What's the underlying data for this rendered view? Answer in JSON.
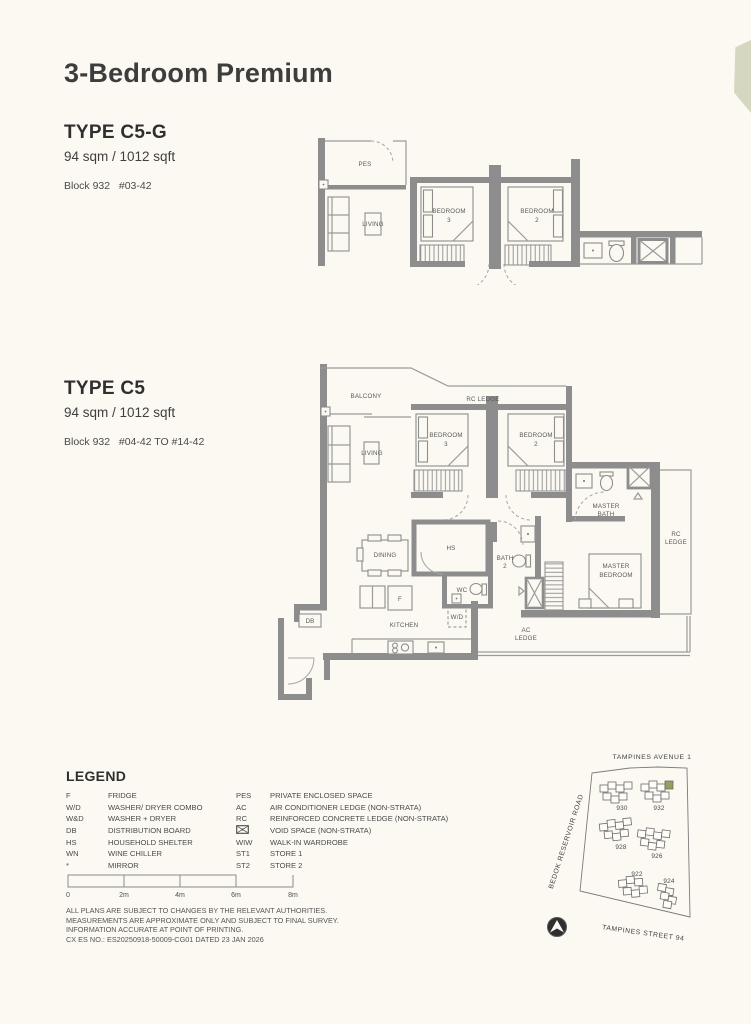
{
  "page": {
    "title": "3-Bedroom Premium"
  },
  "colors": {
    "accent_tab": "#d5d7c0",
    "wall_gray": "#8d8d8d",
    "map_highlight_unit": "#95a05c"
  },
  "unit1": {
    "heading": "TYPE C5-G",
    "area": "94 sqm / 1012 sqft",
    "block": "Block 932   #03-42"
  },
  "unit2": {
    "heading": "TYPE C5",
    "area": "94 sqm / 1012 sqft",
    "block": "Block 932   #04-42 TO #14-42"
  },
  "plan1": {
    "labels": {
      "pes": "PES",
      "living": "LIVING",
      "bed3": [
        "BEDROOM",
        "3"
      ],
      "bed2": [
        "BEDROOM",
        "2"
      ]
    }
  },
  "plan2": {
    "labels": {
      "balcony": "BALCONY",
      "rc_ledge_top": "RC LEDGE",
      "living": "LIVING",
      "bed3": [
        "BEDROOM",
        "3"
      ],
      "bed2": [
        "BEDROOM",
        "2"
      ],
      "master_bath": [
        "MASTER",
        "BATH"
      ],
      "rc_ledge_right": [
        "RC",
        "LEDGE"
      ],
      "dining": "DINING",
      "hs": "HS",
      "bath2": [
        "BATH",
        "2"
      ],
      "wc": "WC",
      "master_bedroom": [
        "MASTER",
        "BEDROOM"
      ],
      "fridge": "F",
      "wd": "W/D",
      "kitchen": "KITCHEN",
      "ac_ledge": [
        "AC",
        "LEDGE"
      ],
      "db": "DB"
    }
  },
  "legend": {
    "title": "LEGEND",
    "left": [
      {
        "abbr": "F",
        "desc": "FRIDGE"
      },
      {
        "abbr": "W/D",
        "desc": "WASHER/ DRYER COMBO"
      },
      {
        "abbr": "W&D",
        "desc": "WASHER + DRYER"
      },
      {
        "abbr": "DB",
        "desc": "DISTRIBUTION BOARD"
      },
      {
        "abbr": "HS",
        "desc": "HOUSEHOLD SHELTER"
      },
      {
        "abbr": "WN",
        "desc": "WINE CHILLER"
      },
      {
        "abbr": "*",
        "desc": "MIRROR"
      }
    ],
    "right": [
      {
        "abbr": "PES",
        "desc": "PRIVATE ENCLOSED SPACE"
      },
      {
        "abbr": "AC",
        "desc": "AIR CONDITIONER LEDGE (NON-STRATA)"
      },
      {
        "abbr": "RC",
        "desc": "REINFORCED CONCRETE LEDGE (NON-STRATA)"
      },
      {
        "abbr": "",
        "icon": "void-space-box",
        "desc": "VOID SPACE (NON-STRATA)"
      },
      {
        "abbr": "WIW",
        "desc": "WALK-IN WARDROBE"
      },
      {
        "abbr": "ST1",
        "desc": "STORE 1"
      },
      {
        "abbr": "ST2",
        "desc": "STORE 2"
      }
    ]
  },
  "scalebar": {
    "ticks": [
      "0",
      "2m",
      "4m",
      "6m",
      "8m"
    ]
  },
  "disclaimer": {
    "lines": [
      "ALL PLANS ARE SUBJECT TO CHANGES BY THE RELEVANT AUTHORITIES.",
      "MEASUREMENTS ARE APPROXIMATE ONLY AND SUBJECT TO FINAL SURVEY.",
      "INFORMATION ACCURATE AT POINT OF PRINTING.",
      "CX ES NO.: ES20250918-50009-CG01 DATED 23 JAN 2026"
    ]
  },
  "map": {
    "road_top": "TAMPINES AVENUE 1",
    "road_left": "BEDOK RESERVOIR ROAD",
    "road_bottom": "TAMPINES STREET 94",
    "blocks": [
      "930",
      "932",
      "928",
      "926",
      "922",
      "924"
    ]
  }
}
